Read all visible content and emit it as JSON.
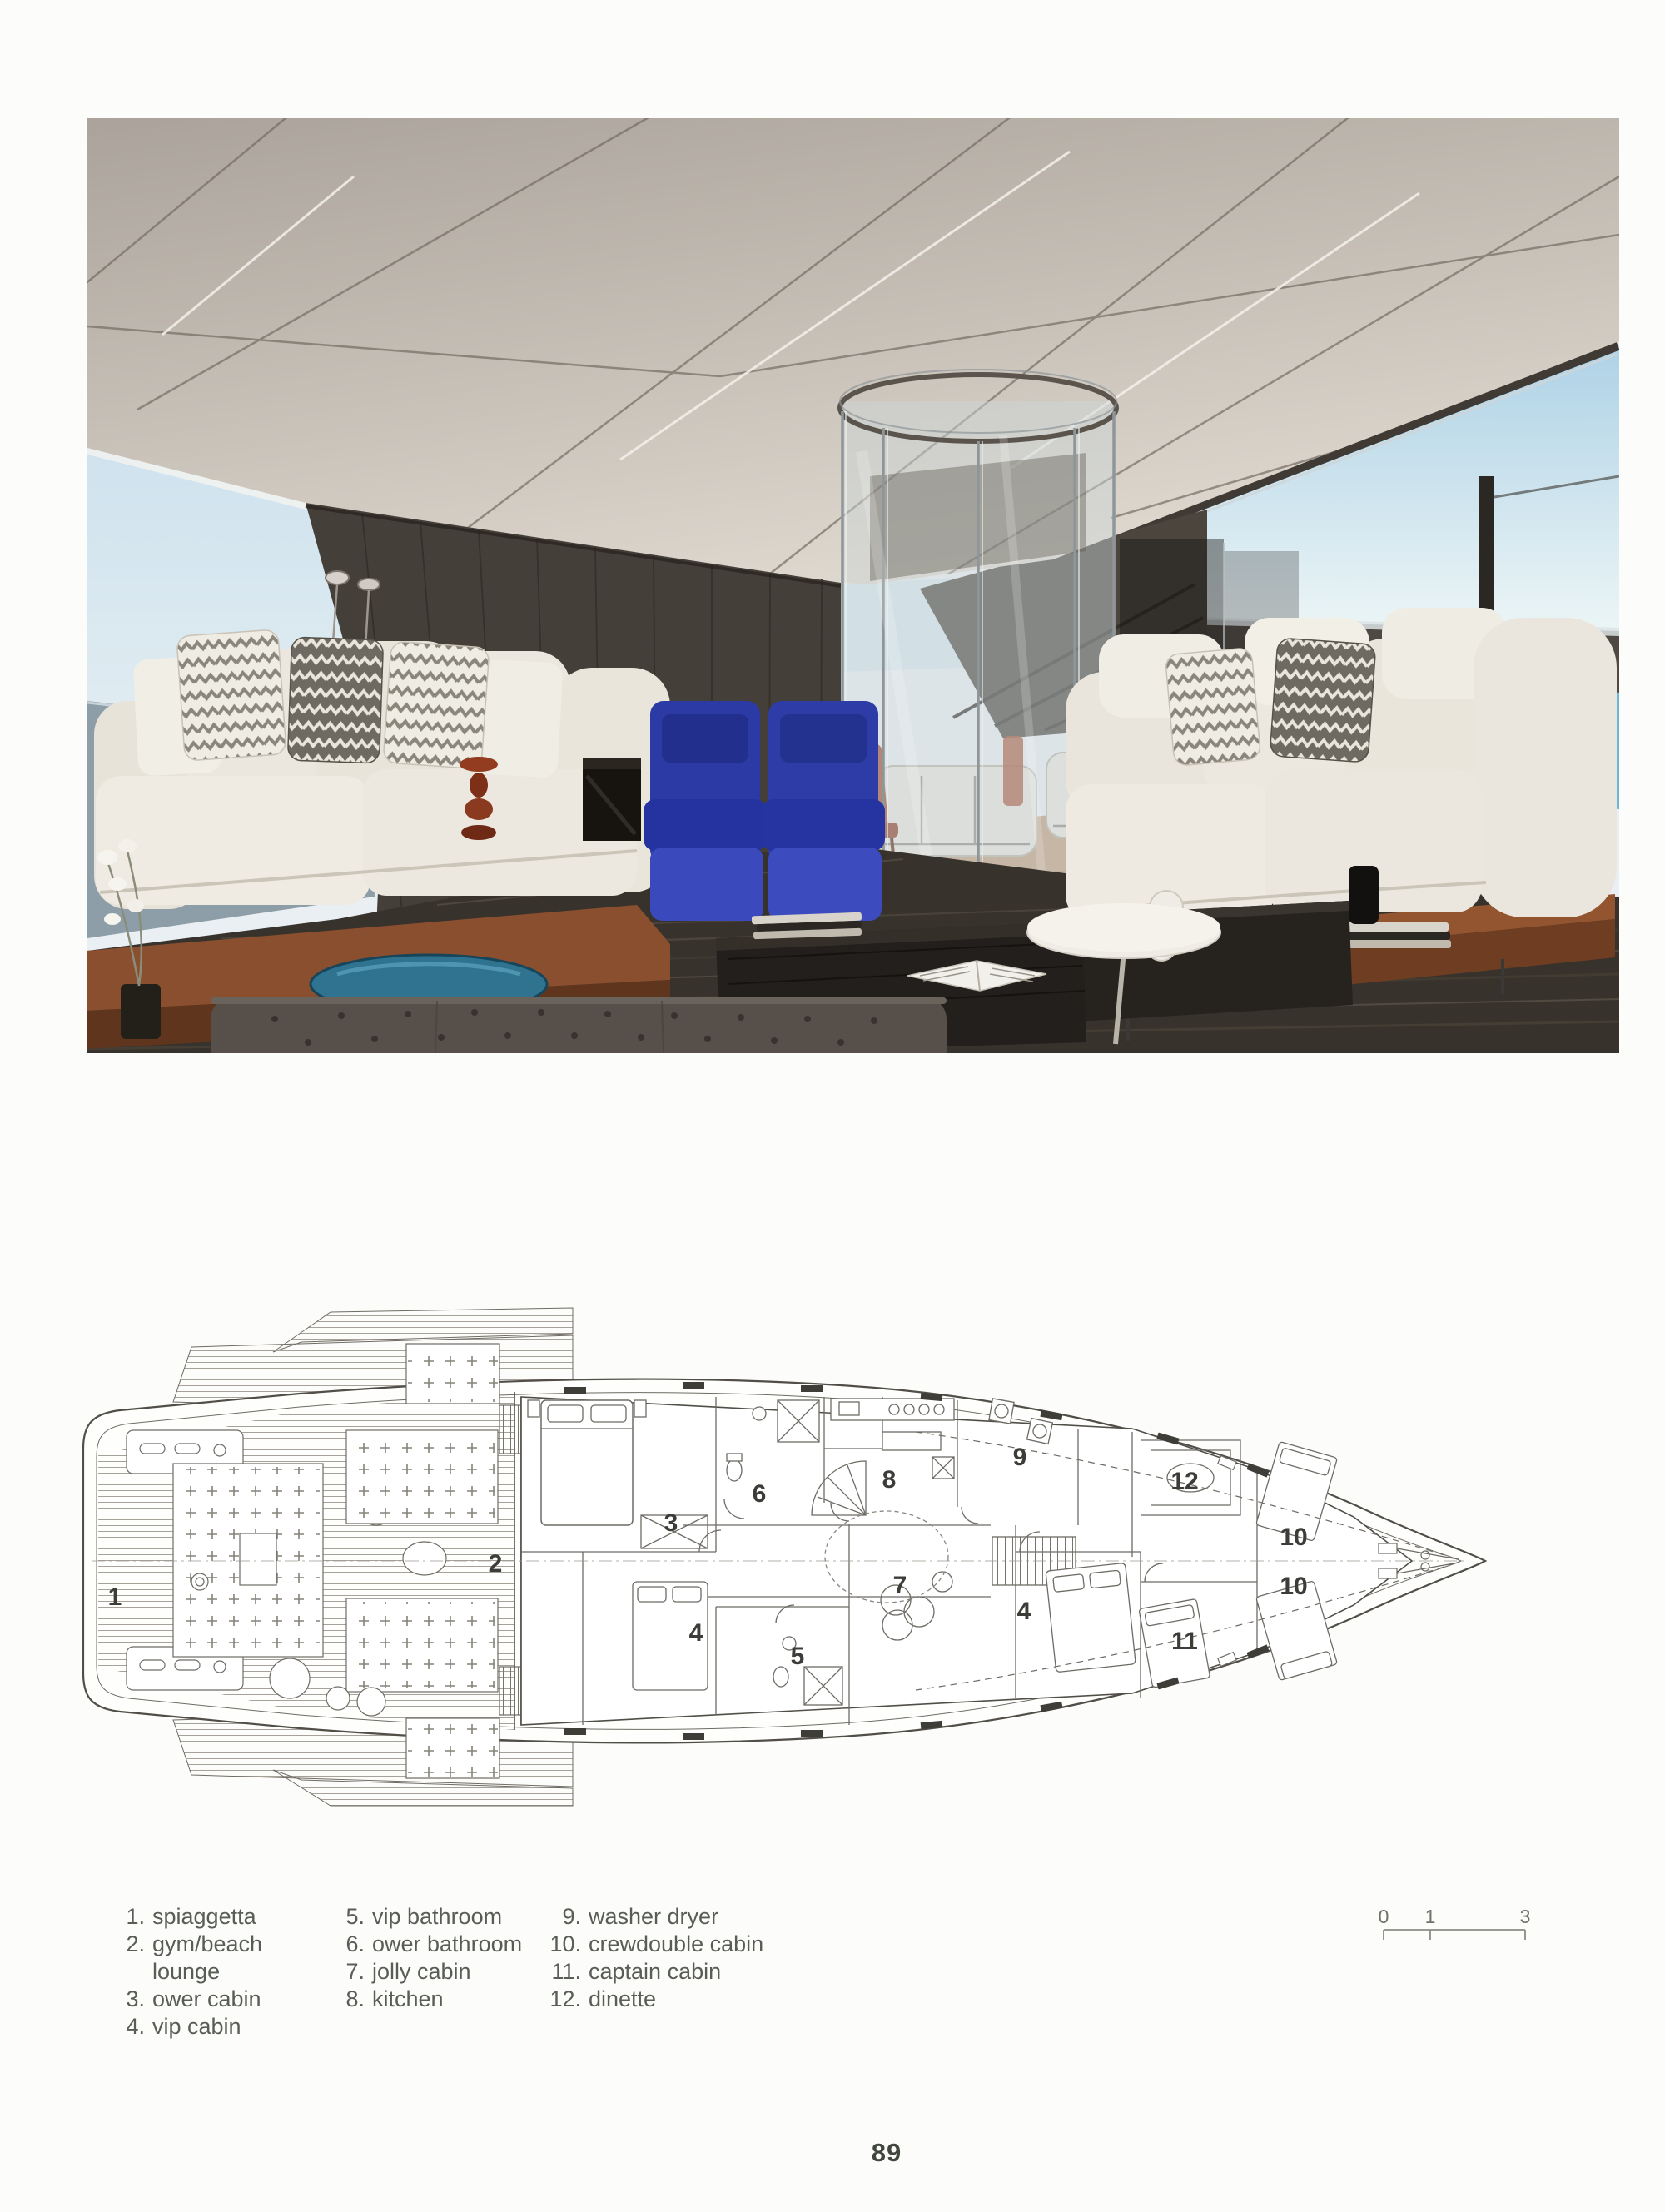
{
  "page": {
    "number": "89"
  },
  "photo": {
    "alt": "yacht main saloon with white sofas, chevron cushions, two blue armchairs, glass elevator column and sea views",
    "colors": {
      "ceiling": "#c3bbb2",
      "wood_wall": "#453f39",
      "sofa": "#eae6dd",
      "blue_chair": "#2e3ca8",
      "rug": "#37322c",
      "sky": "#cfe4ee",
      "sea": "#6fb6d4",
      "wood_platform": "#7a452c",
      "wood_floor": "#c49e7d",
      "blue_glass_table": "#2f7390"
    }
  },
  "floor_plan": {
    "alt": "lower deck general arrangement plan of the yacht",
    "labels": [
      "1",
      "2",
      "3",
      "4",
      "4",
      "5",
      "6",
      "7",
      "8",
      "9",
      "10",
      "10",
      "11",
      "12"
    ],
    "scale_bar": {
      "ticks": [
        "0",
        "1",
        "3"
      ]
    },
    "line_color": "#6e6b64"
  },
  "legend": {
    "columns": [
      {
        "items": [
          {
            "num": "1.",
            "label": "spiaggetta"
          },
          {
            "num": "2.",
            "label": "gym/beach lounge"
          },
          {
            "num": "3.",
            "label": "ower cabin"
          },
          {
            "num": "4.",
            "label": "vip cabin"
          }
        ]
      },
      {
        "items": [
          {
            "num": "5.",
            "label": "vip bathroom"
          },
          {
            "num": "6.",
            "label": "ower bathroom"
          },
          {
            "num": "7.",
            "label": "jolly cabin"
          },
          {
            "num": "8.",
            "label": "kitchen"
          }
        ]
      },
      {
        "items": [
          {
            "num": "9.",
            "label": "washer dryer"
          },
          {
            "num": "10.",
            "label": "crewdouble cabin"
          },
          {
            "num": "11.",
            "label": "captain cabin"
          },
          {
            "num": "12.",
            "label": "dinette"
          }
        ]
      }
    ]
  }
}
